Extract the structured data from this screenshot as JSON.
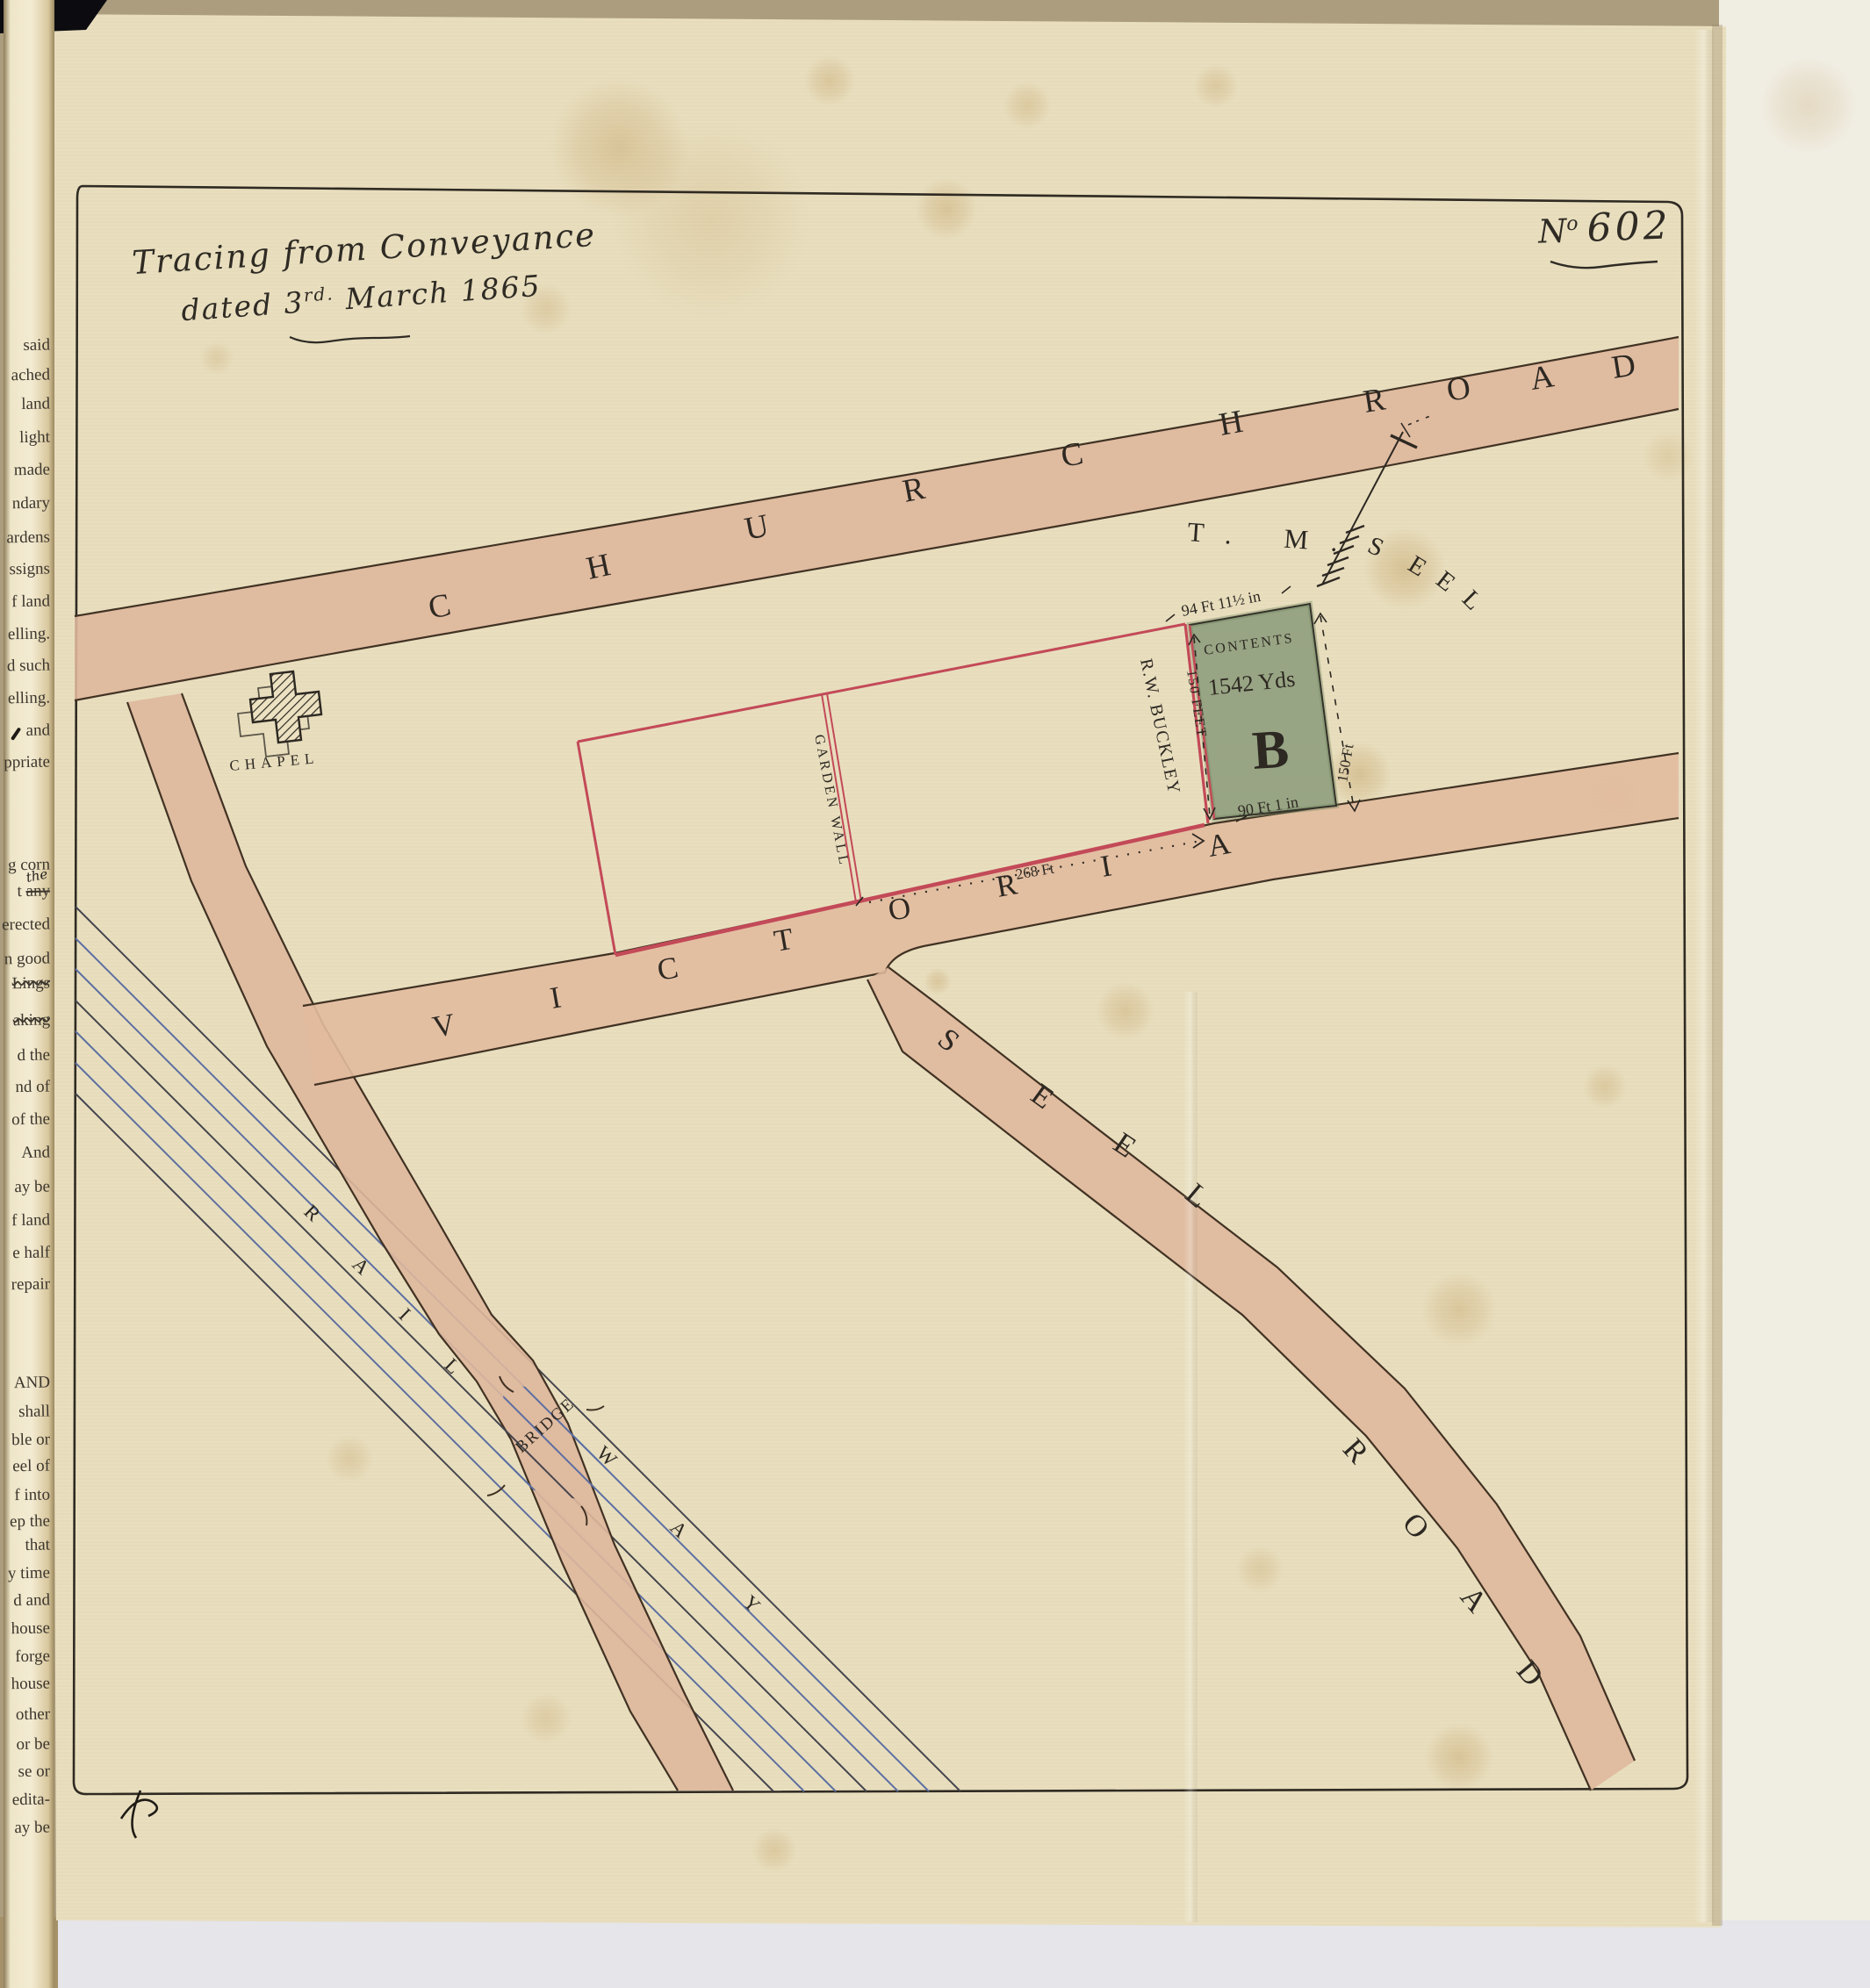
{
  "plan_number": {
    "n": "N",
    "o": "o",
    "value": "602"
  },
  "title": {
    "line1": "Tracing from Conveyance",
    "line2_pre": "dated 3",
    "line2_sup": "rd.",
    "line2_post": " March 1865"
  },
  "map": {
    "roads": {
      "church": [
        "C",
        "H",
        "U",
        "R",
        "C",
        "H"
      ],
      "church_road": [
        "R",
        "O",
        "A",
        "D"
      ],
      "victoria": [
        "V",
        "I",
        "C",
        "T",
        "O",
        "R",
        "I",
        "A"
      ],
      "seel": [
        "S",
        "E",
        "E",
        "L"
      ],
      "seel_road": [
        "R",
        "O",
        "A",
        "D"
      ],
      "railway": [
        "R",
        "A",
        "I",
        "L",
        "W",
        "A",
        "Y"
      ],
      "bridge": "BRIDGE"
    },
    "chapel": "CHAPEL",
    "garden_wall": "GARDEN WALL",
    "owner_tm": "T. M.",
    "owner_seel": [
      "S",
      "E",
      "E",
      "L"
    ],
    "owner_buckley": "R.W. BUCKLEY",
    "plot_b": {
      "contents": "CONTENTS",
      "area": "1542 Yds",
      "name": "B",
      "dim_top": "94 Ft 11½ in",
      "dim_left": "150 FEET",
      "dim_right": "150 Ft",
      "dim_bottom": "90 Ft 1 in"
    },
    "frontage": "268 Ft"
  },
  "colors": {
    "paper": "#e9dfbf",
    "road_fill": "#deb79c",
    "boundary_red": "#c34a58",
    "plot_green": "#90a07f",
    "rail_blue": "#5c6fa0",
    "ink": "#2d2822"
  },
  "margin": {
    "fragments": [
      "said",
      "ached",
      "land",
      "light",
      "made",
      "ndary",
      "ardens",
      "ssigns",
      "f land",
      "elling.",
      "d such",
      "elling.",
      "and",
      "ppriate",
      "g corn",
      {
        "pre": "t ",
        "struck": "any",
        "above": "the"
      },
      "erected",
      "n good",
      {
        "struck": "Lings"
      },
      {
        "struck": "aking"
      },
      "d the",
      "nd of",
      "of the",
      "And",
      "ay be",
      "f land",
      "e half",
      "repair",
      "AND",
      "shall",
      "ble or",
      "eel of",
      "f into",
      "ep the",
      "that",
      "y time",
      "d and",
      "house",
      "forge",
      "house",
      "other",
      "or be",
      "se or",
      "edita-",
      "ay be"
    ]
  }
}
